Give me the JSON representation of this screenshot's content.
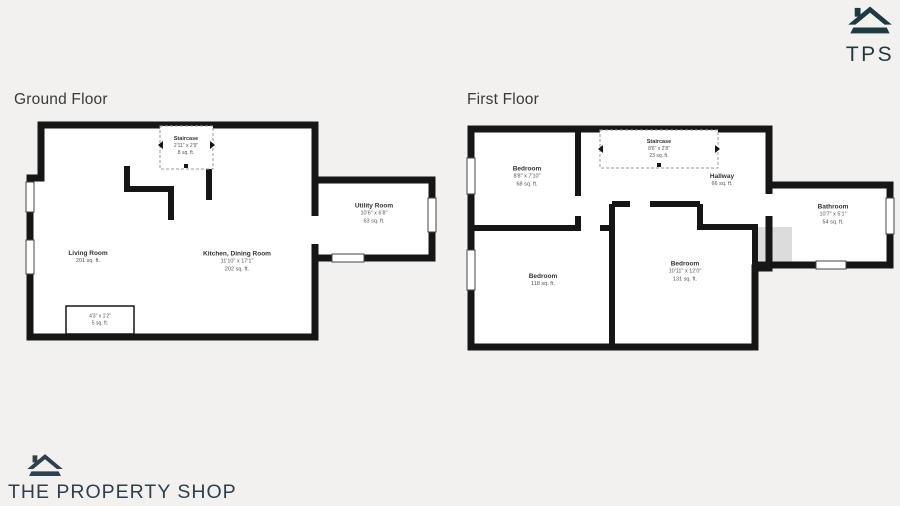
{
  "header": {
    "logo_text": "TPS"
  },
  "footer": {
    "brand_name": "THE PROPERTY SHOP"
  },
  "colors": {
    "page_background": "#f2f1ef",
    "wall": "#161616",
    "tps_logo": "#1e3a40",
    "footer_logo": "#2e3f4e",
    "void_fill": "#dcdcdc"
  },
  "floors": [
    {
      "title": "Ground Floor",
      "rooms": [
        {
          "name": "Staircase",
          "dims": "2'11\" x 2'9\"",
          "area": "8 sq. ft."
        },
        {
          "name": "Living Room",
          "area": "201 sq. ft."
        },
        {
          "name": "Kitchen, Dining Room",
          "dims": "11'10\" x 17'1\"",
          "area": "202 sq. ft."
        },
        {
          "name": "Utility Room",
          "dims": "10'6\" x 6'8\"",
          "area": "63 sq. ft."
        },
        {
          "dims": "4'3\" x 1'2\"",
          "area": "5 sq. ft."
        }
      ]
    },
    {
      "title": "First Floor",
      "rooms": [
        {
          "name": "Bedroom",
          "dims": "8'8\" x 7'10\"",
          "area": "68 sq. ft."
        },
        {
          "name": "Staircase",
          "dims": "8'6\" x 2'8\"",
          "area": "23 sq. ft."
        },
        {
          "name": "Hallway",
          "area": "66 sq. ft."
        },
        {
          "name": "Bathroom",
          "dims": "10'7\" x 5'1\"",
          "area": "54 sq. ft."
        },
        {
          "name": "Bedroom",
          "area": "118 sq. ft."
        },
        {
          "name": "Bedroom",
          "dims": "10'11\" x 12'0\"",
          "area": "131 sq. ft."
        }
      ]
    }
  ]
}
